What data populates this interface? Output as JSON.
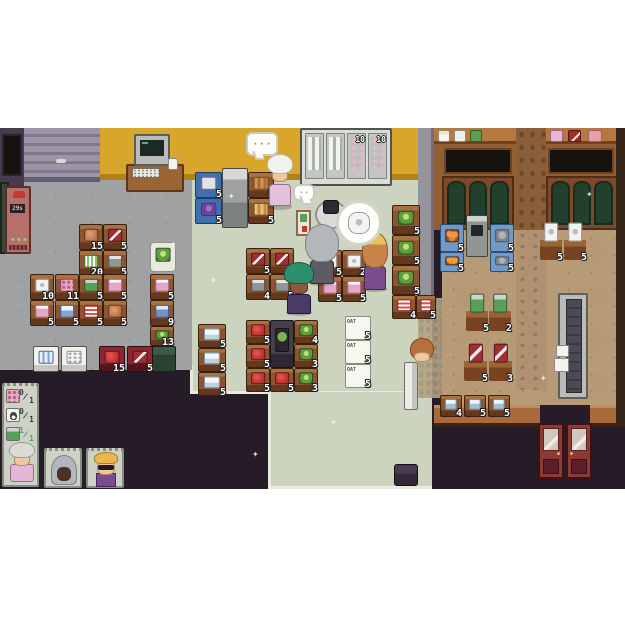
{
  "bubbles": {
    "dots": "· · ·",
    "small_dots": "· ·"
  },
  "fridge_wall": {
    "tags": [
      "10",
      "10"
    ]
  },
  "butcher_machine": {
    "screen": "29s"
  },
  "ui": {
    "shopping_list": [
      {
        "icon": "flower-meat",
        "have": "0",
        "need": "1",
        "done": false
      },
      {
        "icon": "penguin-box",
        "have": "0",
        "need": "1",
        "done": false
      },
      {
        "icon": "green-can",
        "have": "1",
        "need": "1",
        "done": true
      }
    ],
    "customers": [
      {
        "id": "granny"
      },
      {
        "id": "hooded"
      },
      {
        "id": "blond-sunglasses"
      }
    ]
  },
  "sprites": [
    {
      "name": "shelf-toilet-paper",
      "x": 30,
      "y": 146,
      "w": 24,
      "h": 26,
      "item": "tp",
      "num": "10",
      "inter": true
    },
    {
      "name": "shelf-pink-bottle",
      "x": 30,
      "y": 172,
      "w": 24,
      "h": 26,
      "item": "pinkbottle",
      "num": "5",
      "inter": true
    },
    {
      "name": "shelf-flower-meat",
      "x": 55,
      "y": 146,
      "w": 24,
      "h": 26,
      "item": "flowermeat",
      "num": "11",
      "inter": true
    },
    {
      "name": "shelf-milk-box",
      "x": 55,
      "y": 172,
      "w": 24,
      "h": 26,
      "item": "milkbox",
      "num": "5",
      "inter": true
    },
    {
      "name": "shelf-ham",
      "x": 79,
      "y": 96,
      "w": 24,
      "h": 26,
      "item": "ham",
      "num": "15",
      "inter": true
    },
    {
      "name": "shelf-cereal-green",
      "x": 79,
      "y": 122,
      "w": 24,
      "h": 26,
      "item": "cerealgreen",
      "num": "20",
      "inter": true
    },
    {
      "name": "shelf-can-green",
      "x": 79,
      "y": 146,
      "w": 24,
      "h": 26,
      "item": "cangreen",
      "num": "5",
      "inter": true
    },
    {
      "name": "shelf-cereal-stripe",
      "x": 79,
      "y": 172,
      "w": 24,
      "h": 26,
      "item": "cerealstripe",
      "num": "5",
      "inter": true
    },
    {
      "name": "shelf-salmon",
      "x": 103,
      "y": 96,
      "w": 24,
      "h": 26,
      "item": "fish",
      "num": "5",
      "inter": true
    },
    {
      "name": "shelf-can-grey",
      "x": 103,
      "y": 122,
      "w": 24,
      "h": 26,
      "item": "cangrey",
      "num": "5",
      "inter": true
    },
    {
      "name": "shelf-pink-bottle",
      "x": 103,
      "y": 146,
      "w": 24,
      "h": 26,
      "item": "pinkbottle",
      "num": "5",
      "inter": true
    },
    {
      "name": "shelf-ham",
      "x": 103,
      "y": 172,
      "w": 24,
      "h": 26,
      "item": "ham",
      "num": "5",
      "inter": true
    },
    {
      "name": "cabbage-basket",
      "x": 150,
      "y": 114,
      "w": 26,
      "h": 30,
      "cls": "basket",
      "item": "cabbage",
      "inter": true
    },
    {
      "name": "shelf-pink-bottle",
      "x": 150,
      "y": 146,
      "w": 24,
      "h": 26,
      "item": "pinkbottle",
      "num": "5",
      "inter": true
    },
    {
      "name": "shelf-blue-box",
      "x": 150,
      "y": 172,
      "w": 24,
      "h": 26,
      "item": "bluebox",
      "num": "9",
      "inter": true
    },
    {
      "name": "shelf-cabbage",
      "x": 150,
      "y": 198,
      "w": 24,
      "h": 20,
      "item": "cabbage",
      "num": "13",
      "inter": true
    },
    {
      "name": "dumpster",
      "x": 148,
      "y": 218,
      "w": 28,
      "h": 26,
      "cls": "dumpster",
      "inter": true
    },
    {
      "name": "fridge-bottles",
      "x": 33,
      "y": 218,
      "w": 26,
      "h": 26,
      "cls": "whitefridge",
      "item": "bluebottles",
      "inter": true
    },
    {
      "name": "egg-box-stand",
      "x": 61,
      "y": 218,
      "w": 26,
      "h": 26,
      "cls": "whitefridge",
      "item": "eggbox",
      "inter": true
    },
    {
      "name": "shelf-apples-low",
      "x": 99,
      "y": 218,
      "w": 26,
      "h": 26,
      "cls": "redshelf",
      "item": "apple",
      "num": "15",
      "inter": true
    },
    {
      "name": "shelf-salmon-low",
      "x": 127,
      "y": 218,
      "w": 26,
      "h": 26,
      "cls": "redshelf",
      "item": "fish",
      "num": "5",
      "inter": true
    },
    {
      "name": "shelf-water-jug",
      "x": 198,
      "y": 196,
      "w": 28,
      "h": 24,
      "item": "waterjug",
      "num": "5",
      "inter": true
    },
    {
      "name": "shelf-water-jug",
      "x": 198,
      "y": 220,
      "w": 28,
      "h": 24,
      "item": "waterjug",
      "num": "5",
      "inter": true
    },
    {
      "name": "shelf-water-jug",
      "x": 198,
      "y": 244,
      "w": 28,
      "h": 24,
      "item": "waterjug",
      "num": "5",
      "inter": true
    },
    {
      "name": "shelf-salmon",
      "x": 246,
      "y": 120,
      "w": 24,
      "h": 26,
      "item": "fish",
      "num": "5",
      "inter": true
    },
    {
      "name": "shelf-salmon",
      "x": 270,
      "y": 120,
      "w": 24,
      "h": 26,
      "item": "fish",
      "num": "5",
      "inter": true
    },
    {
      "name": "shelf-can-grey",
      "x": 246,
      "y": 146,
      "w": 24,
      "h": 26,
      "item": "cangrey",
      "num": "4",
      "inter": true
    },
    {
      "name": "shelf-can-grey",
      "x": 270,
      "y": 146,
      "w": 24,
      "h": 26,
      "item": "cangrey",
      "num": "5",
      "inter": true
    },
    {
      "name": "shelf-toilet-paper",
      "x": 318,
      "y": 122,
      "w": 24,
      "h": 26,
      "item": "tp",
      "num": "5",
      "inter": true
    },
    {
      "name": "shelf-toilet-paper",
      "x": 342,
      "y": 122,
      "w": 24,
      "h": 26,
      "item": "tp",
      "num": "2",
      "inter": true
    },
    {
      "name": "shelf-pink-bottle",
      "x": 318,
      "y": 148,
      "w": 24,
      "h": 26,
      "item": "pinkbottle",
      "num": "5",
      "inter": true
    },
    {
      "name": "shelf-pink-bottle",
      "x": 342,
      "y": 148,
      "w": 24,
      "h": 26,
      "item": "pinkbottle",
      "num": "5",
      "inter": true
    },
    {
      "name": "shelf-apples",
      "x": 246,
      "y": 192,
      "w": 24,
      "h": 24,
      "item": "apple",
      "num": "5",
      "inter": true
    },
    {
      "name": "shelf-apples",
      "x": 246,
      "y": 216,
      "w": 24,
      "h": 24,
      "item": "apple",
      "num": "5",
      "inter": true
    },
    {
      "name": "shelf-apples",
      "x": 246,
      "y": 240,
      "w": 24,
      "h": 24,
      "item": "apple",
      "num": "5",
      "inter": true
    },
    {
      "name": "seed-stand",
      "x": 270,
      "y": 192,
      "w": 24,
      "h": 48,
      "cls": "plantstand",
      "item": "plantsprout",
      "inter": true
    },
    {
      "name": "shelf-apples",
      "x": 270,
      "y": 240,
      "w": 24,
      "h": 24,
      "item": "apple",
      "num": "5",
      "inter": true
    },
    {
      "name": "shelf-cabbage",
      "x": 294,
      "y": 192,
      "w": 24,
      "h": 24,
      "item": "cabbage",
      "num": "4",
      "inter": true
    },
    {
      "name": "shelf-cabbage",
      "x": 294,
      "y": 216,
      "w": 24,
      "h": 24,
      "item": "cabbage",
      "num": "3",
      "inter": true
    },
    {
      "name": "shelf-cabbage",
      "x": 294,
      "y": 240,
      "w": 24,
      "h": 24,
      "item": "cabbage",
      "num": "3",
      "inter": true
    },
    {
      "name": "shelf-oat-box",
      "x": 345,
      "y": 188,
      "w": 26,
      "h": 24,
      "cls": "oatbox",
      "label": "OAT",
      "num": "5",
      "inter": true
    },
    {
      "name": "shelf-oat-box",
      "x": 345,
      "y": 212,
      "w": 26,
      "h": 24,
      "cls": "oatbox",
      "label": "OAT",
      "num": "5",
      "inter": true
    },
    {
      "name": "shelf-oat-box",
      "x": 345,
      "y": 236,
      "w": 26,
      "h": 24,
      "cls": "oatbox",
      "label": "OAT",
      "num": "5",
      "inter": true
    },
    {
      "name": "cabbage-tier",
      "x": 392,
      "y": 77,
      "w": 28,
      "h": 30,
      "item": "cabbage",
      "num": "5",
      "inter": true
    },
    {
      "name": "cabbage-tier",
      "x": 392,
      "y": 107,
      "w": 28,
      "h": 30,
      "item": "cabbage",
      "num": "5",
      "inter": true
    },
    {
      "name": "cabbage-tier",
      "x": 392,
      "y": 137,
      "w": 28,
      "h": 30,
      "item": "cabbage",
      "num": "5",
      "inter": true
    },
    {
      "name": "shelf-cereal-stripe",
      "x": 392,
      "y": 167,
      "w": 24,
      "h": 24,
      "item": "cerealstripe",
      "num": "4",
      "inter": true
    },
    {
      "name": "shelf-cereal-stripe",
      "x": 416,
      "y": 167,
      "w": 20,
      "h": 24,
      "item": "cerealstripe",
      "num": "5",
      "inter": true
    },
    {
      "name": "display-meat",
      "x": 195,
      "y": 44,
      "w": 27,
      "h": 26,
      "cls": "bluedisplay",
      "item": "meatpink",
      "num": "5",
      "inter": true
    },
    {
      "name": "display-eggplant",
      "x": 195,
      "y": 70,
      "w": 27,
      "h": 26,
      "cls": "bluedisplay",
      "item": "purplefruit",
      "num": "5",
      "inter": true
    },
    {
      "name": "bread-shelf",
      "x": 248,
      "y": 44,
      "w": 26,
      "h": 26,
      "item": "bread",
      "num": "5",
      "inter": true
    },
    {
      "name": "bread-shelf",
      "x": 248,
      "y": 70,
      "w": 26,
      "h": 26,
      "item": "bread2",
      "num": "5",
      "inter": true
    },
    {
      "name": "crate-oranges",
      "x": 440,
      "y": 96,
      "w": 24,
      "h": 28,
      "cls": "crate",
      "item": "oranges",
      "num": "5",
      "inter": true
    },
    {
      "name": "crate-oranges",
      "x": 440,
      "y": 124,
      "w": 24,
      "h": 20,
      "cls": "crate",
      "item": "oranges",
      "num": "5",
      "inter": true
    },
    {
      "name": "crate-goods",
      "x": 490,
      "y": 96,
      "w": 24,
      "h": 28,
      "cls": "crate",
      "item": "animalface",
      "num": "5",
      "inter": true
    },
    {
      "name": "crate-goods",
      "x": 490,
      "y": 124,
      "w": 24,
      "h": 20,
      "cls": "crate",
      "item": "animalface",
      "num": "5",
      "inter": true
    },
    {
      "name": "toilet-paper-table",
      "x": 540,
      "y": 96,
      "w": 22,
      "h": 36,
      "cls": "table",
      "item": "tp",
      "num": "5",
      "inter": true
    },
    {
      "name": "toilet-paper-table",
      "x": 564,
      "y": 96,
      "w": 22,
      "h": 36,
      "cls": "table",
      "item": "tp",
      "num": "5",
      "inter": true
    },
    {
      "name": "green-can-table",
      "x": 466,
      "y": 167,
      "w": 22,
      "h": 36,
      "cls": "table",
      "item": "cangreen",
      "num": "5",
      "inter": true
    },
    {
      "name": "green-can-table",
      "x": 489,
      "y": 167,
      "w": 22,
      "h": 36,
      "cls": "table",
      "item": "cangreen",
      "num": "2",
      "inter": true
    },
    {
      "name": "salmon-table",
      "x": 464,
      "y": 217,
      "w": 23,
      "h": 36,
      "cls": "table",
      "item": "fish",
      "num": "5",
      "inter": true
    },
    {
      "name": "salmon-table",
      "x": 489,
      "y": 217,
      "w": 23,
      "h": 36,
      "cls": "table",
      "item": "fish",
      "num": "3",
      "inter": true
    },
    {
      "name": "blue-container-shelf",
      "x": 440,
      "y": 267,
      "w": 22,
      "h": 22,
      "item": "bluepot",
      "num": "4",
      "inter": true
    },
    {
      "name": "blue-container-shelf",
      "x": 464,
      "y": 267,
      "w": 22,
      "h": 22,
      "item": "bluepot",
      "num": "5",
      "inter": true
    },
    {
      "name": "blue-container-shelf",
      "x": 488,
      "y": 267,
      "w": 22,
      "h": 22,
      "item": "bluepot",
      "num": "5",
      "inter": true
    },
    {
      "name": "storage-chest",
      "x": 394,
      "y": 336,
      "w": 24,
      "h": 22,
      "cls": "chest",
      "inter": true
    },
    {
      "name": "entrance-freezer",
      "x": 404,
      "y": 234,
      "w": 14,
      "h": 48,
      "cls": "whiteverc",
      "inter": true
    },
    {
      "name": "mini-oat-box",
      "x": 438,
      "y": 2,
      "w": 12,
      "h": 12,
      "cls": "oatmini",
      "inter": false
    },
    {
      "name": "mini-white-box",
      "x": 454,
      "y": 2,
      "w": 12,
      "h": 12,
      "cls": "whiteboxmini",
      "inter": false
    },
    {
      "name": "mini-green-box",
      "x": 470,
      "y": 2,
      "w": 12,
      "h": 12,
      "cls": "greenbox",
      "inter": false
    },
    {
      "name": "mini-pink-box",
      "x": 550,
      "y": 2,
      "w": 13,
      "h": 12,
      "cls": "pinkbox",
      "inter": false
    },
    {
      "name": "mini-red-box",
      "x": 568,
      "y": 2,
      "w": 13,
      "h": 12,
      "cls": "redbox",
      "inter": false
    },
    {
      "name": "mini-meat-slab",
      "x": 588,
      "y": 2,
      "w": 14,
      "h": 12,
      "cls": "meatpink",
      "inter": false
    },
    {
      "name": "sparkle",
      "x": 170,
      "y": 112,
      "w": 8,
      "h": 8,
      "cls": "sparkle",
      "label": "✦",
      "inter": false
    },
    {
      "name": "sparkle",
      "x": 228,
      "y": 64,
      "w": 8,
      "h": 8,
      "cls": "sparkle",
      "label": "✦",
      "inter": false
    },
    {
      "name": "sparkle",
      "x": 210,
      "y": 148,
      "w": 8,
      "h": 8,
      "cls": "sparkle",
      "label": "✦",
      "inter": false
    },
    {
      "name": "sparkle",
      "x": 296,
      "y": 168,
      "w": 8,
      "h": 8,
      "cls": "sparkle",
      "label": "✦",
      "inter": false
    },
    {
      "name": "sparkle",
      "x": 330,
      "y": 290,
      "w": 8,
      "h": 8,
      "cls": "sparkle",
      "label": "✦",
      "inter": false
    },
    {
      "name": "sparkle",
      "x": 252,
      "y": 322,
      "w": 8,
      "h": 8,
      "cls": "sparkle",
      "label": "✦",
      "inter": false
    },
    {
      "name": "sparkle",
      "x": 540,
      "y": 246,
      "w": 8,
      "h": 8,
      "cls": "sparkle",
      "label": "✦",
      "inter": false
    },
    {
      "name": "sparkle",
      "x": 586,
      "y": 62,
      "w": 8,
      "h": 8,
      "cls": "sparkle",
      "label": "✦",
      "inter": false
    }
  ]
}
